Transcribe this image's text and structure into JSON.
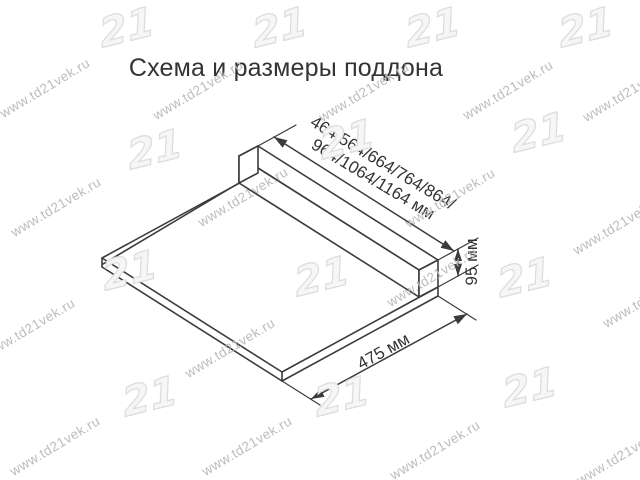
{
  "title": "Схема и размеры поддона",
  "diagram": {
    "length_dimension": {
      "line1": "464/564/664/764/864/",
      "line2": "964/1064/1164 мм"
    },
    "height_dimension": {
      "label": "95 мм"
    },
    "depth_dimension": {
      "label": "475 мм"
    }
  },
  "watermark": {
    "text": "www.td21vek.ru",
    "logo_text": "21"
  },
  "colors": {
    "line": "#3b3b3b",
    "text": "#333333",
    "watermark_text": "#bcbcbc",
    "watermark_logo": "#dddddd",
    "background": "#ffffff"
  }
}
